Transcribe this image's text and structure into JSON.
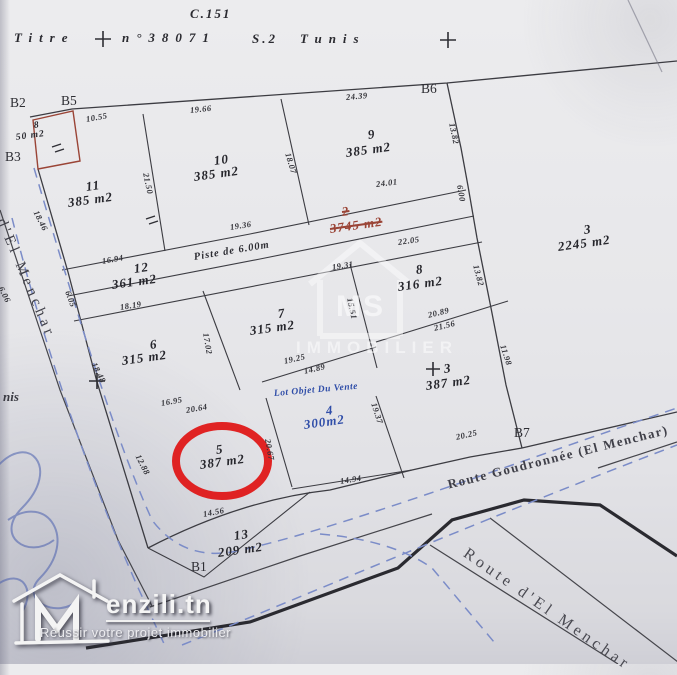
{
  "title": {
    "sheet_ref": "C.151",
    "label": "Titre",
    "number": "n°38071",
    "section": "S.2",
    "city": "Tunis"
  },
  "boundary_markers": [
    "B2",
    "B5",
    "B3",
    "B6",
    "B7",
    "B1"
  ],
  "parcels": [
    {
      "id": "p8small",
      "number": "8",
      "area": "50 m2"
    },
    {
      "id": "p11",
      "number": "11",
      "area": "385 m2"
    },
    {
      "id": "p10",
      "number": "10",
      "area": "385 m2"
    },
    {
      "id": "p9",
      "number": "9",
      "area": "385 m2"
    },
    {
      "id": "p2",
      "number": "2",
      "area": "3745 m2",
      "struck": true
    },
    {
      "id": "p3big",
      "number": "3",
      "area": "2245 m2"
    },
    {
      "id": "p12",
      "number": "12",
      "area": "361 m2"
    },
    {
      "id": "p8",
      "number": "8",
      "area": "316 m2"
    },
    {
      "id": "p7",
      "number": "7",
      "area": "315 m2"
    },
    {
      "id": "p6",
      "number": "6",
      "area": "315 m2"
    },
    {
      "id": "p3cross",
      "number": "3",
      "area": "387 m2",
      "cross": true
    },
    {
      "id": "p4",
      "number": "4",
      "area": "300m2",
      "note": "Lot Objet Du Vente",
      "highlight": "blue"
    },
    {
      "id": "p5",
      "number": "5",
      "area": "387 m2",
      "circled": true
    },
    {
      "id": "p13",
      "number": "13",
      "area": "209 m2"
    }
  ],
  "dimensions": [
    "10.55",
    "19.66",
    "24.39",
    "13.82",
    "18.07",
    "21.50",
    "24.01",
    "6.00",
    "18.46",
    "16.94",
    "19.36",
    "22.05",
    "13.82",
    "19.31",
    "15.51",
    "18.19",
    "17.02",
    "20.89",
    "21.56",
    "19.25",
    "14.89",
    "18.48",
    "6.05",
    "6.06",
    "16.95",
    "20.64",
    "12.88",
    "20.67",
    "19.37",
    "14.94",
    "20.25",
    "14.56",
    "11.98"
  ],
  "roads": {
    "main": "Route Goudronnée (El Menchar)",
    "branch": "Route d'El Menchar",
    "left": "d'El Menchar",
    "piste": "Piste de 6.00m"
  },
  "fragments": {
    "handwritten": "nis"
  },
  "watermark": {
    "initials": "MS",
    "text": "IMMOBILIER"
  },
  "logo": {
    "brand": "enzili.tn",
    "tagline": "Réussir votre projet immobilier",
    "icon": "m-house-icon"
  },
  "colors": {
    "highlight_red": "#e01212",
    "annotation_blue": "#2f4da8",
    "strike_red": "#9a4436",
    "dash_blue": "#7b8cc8",
    "ink": "#2e2e34",
    "paper": "#e6e6e9"
  }
}
